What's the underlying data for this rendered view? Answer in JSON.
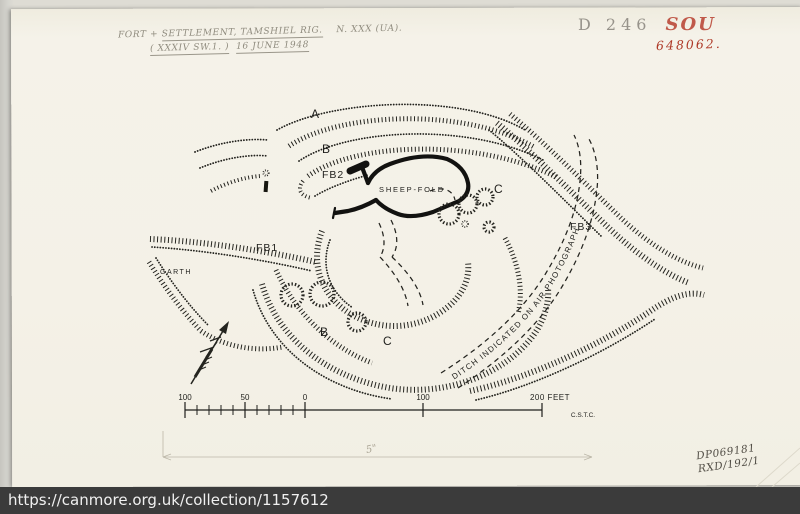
{
  "page": {
    "url": "https://canmore.org.uk/collection/1157612"
  },
  "annotations": {
    "title_prefix": "FORT + ",
    "title_main": "SETTLEMENT, TAMSHIEL RIG.",
    "title_ref": "N. XXX (UA).",
    "title_paren": "( XXXIV SW.1. )",
    "title_date": "16 JUNE 1948",
    "cat_pencil": "D 246",
    "cat_red": "SOU",
    "cat_number": "648062.",
    "photo_ref_line1": "DP069181",
    "photo_ref_line2": "RXD/192/1",
    "width_note": "5\""
  },
  "plan": {
    "labels": {
      "rampart_a": "A",
      "rampart_b_upper": "B",
      "fb1": "FB1",
      "fb2": "FB2",
      "fb3": "FB3",
      "sheep_fold": "SHEEP-FOLD",
      "c_upper": "C",
      "garth": "GARTH",
      "b_lower": "B",
      "c_lower": "C",
      "ditch_note": "DITCH INDICATED ON AIR PHOTOGRAPH",
      "surveyor_initials": "C.S.T.C."
    },
    "scale_bar": {
      "labels": [
        "100",
        "50",
        "0",
        "100",
        "200 FEET"
      ],
      "unit": "FEET"
    }
  },
  "colors": {
    "paper": "#f4f1e8",
    "ink": "#24241f",
    "pencil": "#8f8b7e",
    "red_sou": "#c0594a",
    "red_number": "#ae3a28",
    "url_bar_bg": "#3b3b3b",
    "url_text": "#f0f0f0"
  }
}
